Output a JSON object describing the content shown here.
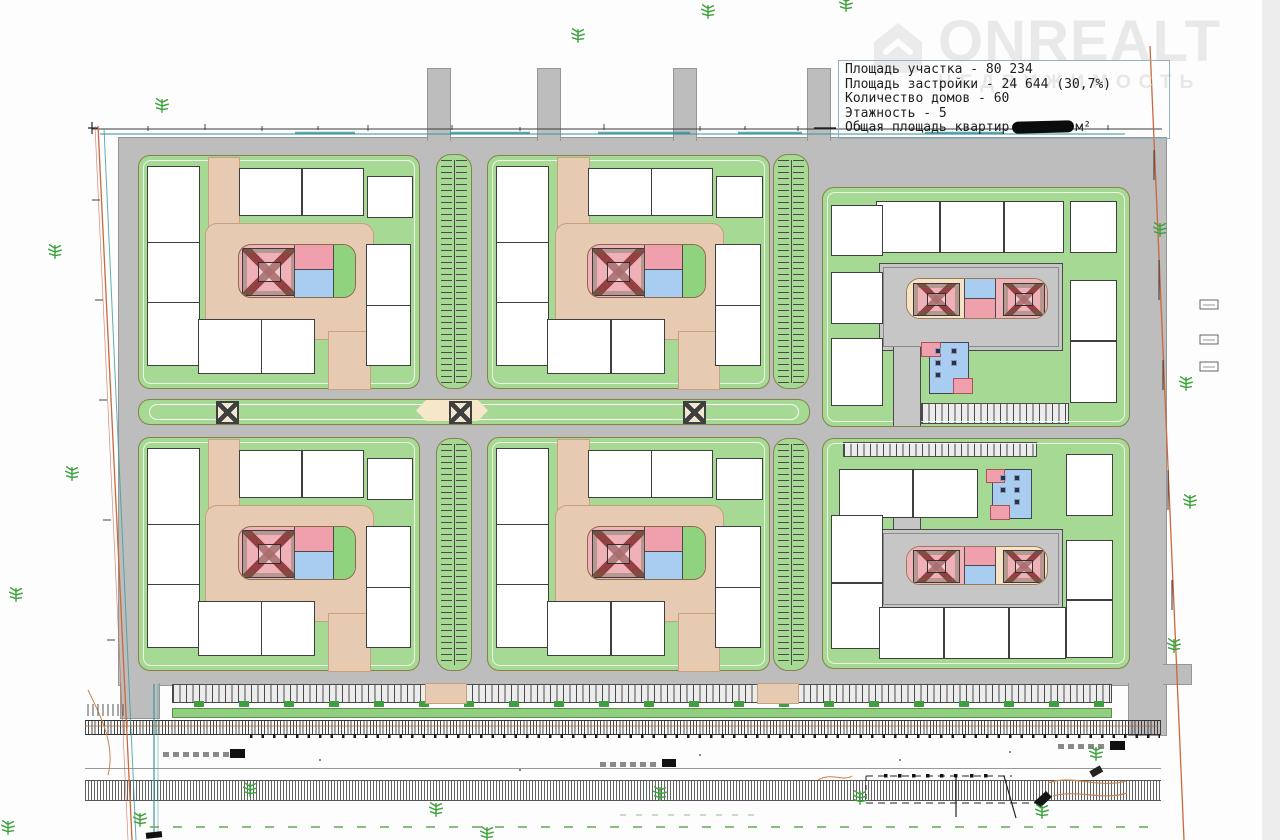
{
  "watermark": {
    "brand": "ONREALT",
    "tagline": "НЕДВИЖИМОСТЬ",
    "logo_icon": "house-icon"
  },
  "info_box": {
    "lines": [
      "Площадь участка - 80 234",
      "Площадь застройки - 24 644 (30,7%)",
      "Количество домов - 60",
      "Этажность - 5"
    ],
    "apartments_prefix": "Общая площадь квартир",
    "apartments_suffix": "м²",
    "apartments_value_redacted": true
  },
  "palette": {
    "road_gray": "#bdbdbd",
    "lawn_green": "#a6da94",
    "path_tan": "#e6cbb2",
    "plaza_cream": "#f6e7c9",
    "playground_pink": "#f0b3ba",
    "accent_pink": "#f0a0ac",
    "sport_blue": "#a9cdf0",
    "court_gray": "#c6c6c6",
    "building_line": "#3f3f3f",
    "block_border": "#85814a",
    "boundary_orange": "#c9693c",
    "utility_teal": "#3a9aa0",
    "tree_green": "#3da23d",
    "watermark_gray": "#e9e9e9",
    "box_border": "#90b2c9",
    "ink": "#1e1e1e"
  }
}
